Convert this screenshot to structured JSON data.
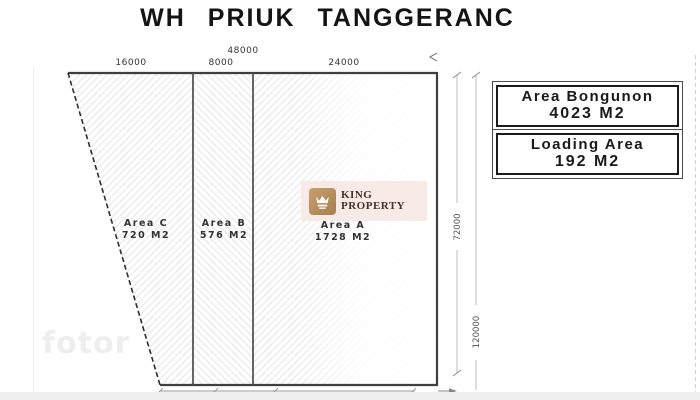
{
  "title": "WH PRIUK TANGGERANC",
  "plan": {
    "dimensions": {
      "total_width": "48000",
      "width_area_c": "16000",
      "width_area_b": "8000",
      "width_area_a": "24000",
      "building_depth": "72000",
      "total_depth": "120000"
    },
    "areas": [
      {
        "name": "Area C",
        "size": "720 M2"
      },
      {
        "name": "Area B",
        "size": "576 M2"
      },
      {
        "name": "Area A",
        "size": "1728 M2"
      }
    ]
  },
  "info_boxes": [
    {
      "label": "Area Bongunon",
      "value": "4023 M2"
    },
    {
      "label": "Loading Area",
      "value": "192 M2"
    }
  ],
  "logo": {
    "icon": "crown-icon",
    "line1": "KING",
    "line2": "PROPERTY"
  },
  "watermark": "fotor",
  "colors": {
    "outline": "#3f3f3f",
    "hatch": "#e5e5e5",
    "dimension_line": "#b5b5b5",
    "dimension_text": "#333333",
    "logo_gold": "#b5905f",
    "logo_text": "#443425",
    "logo_background": "#f7eae7",
    "watermark_gray": "#eeeeee"
  }
}
